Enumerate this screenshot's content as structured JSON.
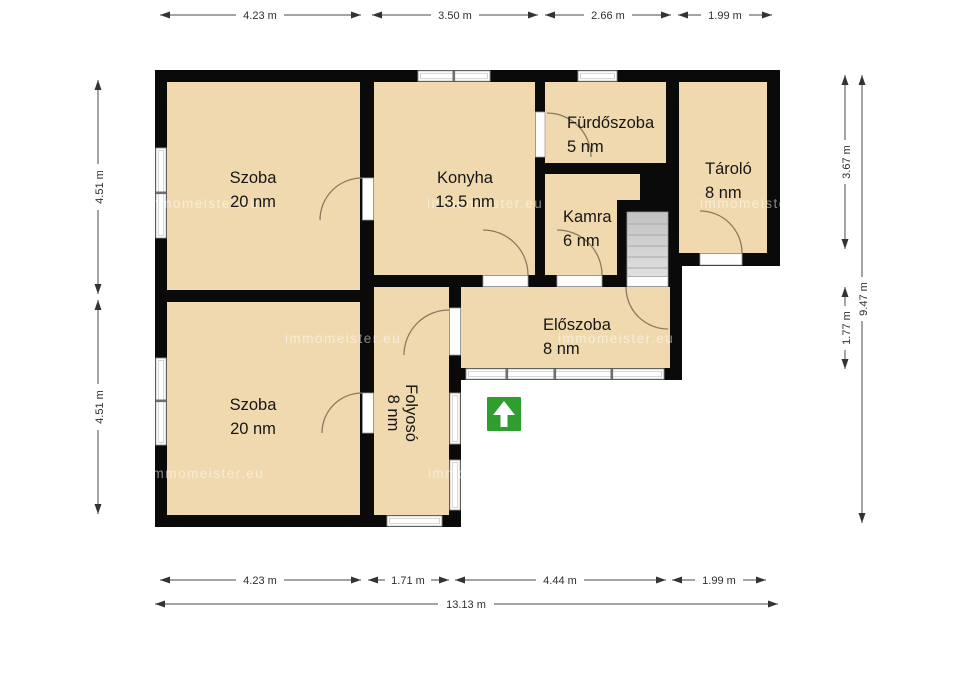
{
  "plan": {
    "rooms": [
      {
        "name": "Szoba",
        "area": "20 nm"
      },
      {
        "name": "Konyha",
        "area": "13.5 nm"
      },
      {
        "name": "Fürdőszoba",
        "area": "5 nm"
      },
      {
        "name": "Kamra",
        "area": "6 nm"
      },
      {
        "name": "Tároló",
        "area": "8 nm"
      },
      {
        "name": "Előszoba",
        "area": "8 nm"
      },
      {
        "name": "Szoba",
        "area": "20 nm"
      },
      {
        "name": "Folyosó",
        "area": "8 nm"
      }
    ],
    "dimensions": {
      "top": [
        "4.23 m",
        "3.50 m",
        "2.66 m",
        "1.99 m"
      ],
      "bottom": [
        "4.23 m",
        "1.71 m",
        "4.44 m",
        "1.99 m"
      ],
      "bottom_total": "13.13 m",
      "left": [
        "4.51 m",
        "4.51 m"
      ],
      "right": [
        "3.67 m",
        "1.77 m"
      ],
      "right_total": "9.47 m"
    },
    "watermark": "immomeister.eu",
    "colors": {
      "floor": "#f0d9ae",
      "wall": "#0a0a0a",
      "stairs_light": "#e0e0e0",
      "stairs_dark": "#c2c2c2",
      "entrance_arrow": "#2f9e2f"
    }
  }
}
